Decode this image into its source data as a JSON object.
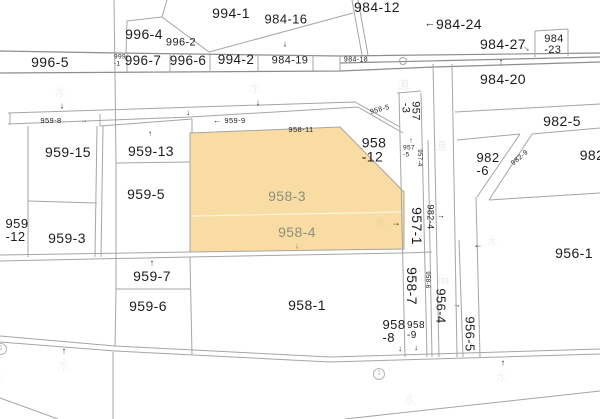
{
  "map": {
    "type": "cadastral-parcel-map",
    "colors": {
      "background": "#ffffff",
      "line": "#a5a5a3",
      "line_dark": "#8d8d8b",
      "highlight_fill": "#f8dca3",
      "highlight_label": "#8c8f7e",
      "label": "#1d1d1d",
      "marker": "#b5b5b5"
    },
    "highlighted_parcels": [
      "958-3",
      "958-4"
    ],
    "labels": [
      {
        "text": "994-1",
        "x": 231,
        "y": 13,
        "size": 14
      },
      {
        "text": "996-4",
        "x": 144,
        "y": 34,
        "size": 14
      },
      {
        "text": "996-2",
        "x": 181,
        "y": 43,
        "size": 11
      },
      {
        "text": "984-16",
        "x": 286,
        "y": 19,
        "size": 13
      },
      {
        "text": "984-12",
        "x": 377,
        "y": 7,
        "size": 14
      },
      {
        "text": "984-24",
        "x": 459,
        "y": 24,
        "size": 14
      },
      {
        "text": "984-27",
        "x": 503,
        "y": 44,
        "size": 14
      },
      {
        "lines": [
          "984",
          "-23"
        ],
        "x": 554,
        "y": 45,
        "size": 11
      },
      {
        "text": "996-5",
        "x": 50,
        "y": 62,
        "size": 14
      },
      {
        "lines": [
          "999",
          "-1"
        ],
        "x": 120,
        "y": 61,
        "size": 6.5
      },
      {
        "text": "996-7",
        "x": 143,
        "y": 61,
        "size": 13.5
      },
      {
        "text": "996-6",
        "x": 188,
        "y": 61,
        "size": 13.5
      },
      {
        "text": "994-2",
        "x": 236,
        "y": 60,
        "size": 13.5
      },
      {
        "text": "984-19",
        "x": 290,
        "y": 61,
        "size": 11
      },
      {
        "text": "984-18",
        "x": 356,
        "y": 60,
        "size": 7
      },
      {
        "text": "道",
        "x": 404,
        "y": 85,
        "size": 16,
        "kanji": "road"
      },
      {
        "text": "984-20",
        "x": 503,
        "y": 79,
        "size": 14
      },
      {
        "text": "水",
        "x": 61,
        "y": 93,
        "size": 16,
        "kanji": "water"
      },
      {
        "text": "水",
        "x": 255,
        "y": 89,
        "size": 16,
        "kanji": "water"
      },
      {
        "text": "959-8",
        "x": 51,
        "y": 121,
        "size": 7.5
      },
      {
        "text": "959-9",
        "x": 235,
        "y": 121,
        "size": 7.5
      },
      {
        "text": "958-11",
        "x": 301,
        "y": 130,
        "size": 7.5
      },
      {
        "text": "958-5",
        "x": 380,
        "y": 110,
        "size": 7,
        "rot": -15
      },
      {
        "text": "957",
        "x": 415,
        "y": 111,
        "size": 11,
        "rot": 90
      },
      {
        "text": "-3",
        "x": 405,
        "y": 108,
        "size": 11,
        "rot": 90
      },
      {
        "text": "959-15",
        "x": 68,
        "y": 152,
        "size": 14
      },
      {
        "text": "959-13",
        "x": 151,
        "y": 151,
        "size": 14
      },
      {
        "lines": [
          "958",
          "-12"
        ],
        "x": 374,
        "y": 150,
        "size": 14
      },
      {
        "text": "982-5",
        "x": 562,
        "y": 121,
        "size": 14
      },
      {
        "text": "982",
        "x": 592,
        "y": 155,
        "size": 14
      },
      {
        "lines": [
          "982",
          "-6"
        ],
        "x": 488,
        "y": 164,
        "size": 13
      },
      {
        "text": "982-9",
        "x": 520,
        "y": 158,
        "size": 7,
        "rot": -40
      },
      {
        "lines": [
          "957",
          "-5"
        ],
        "x": 409,
        "y": 152,
        "size": 6.5
      },
      {
        "text": "957-4",
        "x": 419,
        "y": 158,
        "size": 6,
        "rot": 90
      },
      {
        "text": "道",
        "x": 441,
        "y": 146,
        "size": 16,
        "kanji": "road"
      },
      {
        "text": "959-5",
        "x": 146,
        "y": 194,
        "size": 14
      },
      {
        "lines": [
          "959",
          "-12"
        ],
        "x": 17,
        "y": 230,
        "size": 13
      },
      {
        "text": "959-3",
        "x": 67,
        "y": 238,
        "size": 14
      },
      {
        "text": "958-3",
        "x": 287,
        "y": 196,
        "size": 14,
        "color": "#8c8f7e"
      },
      {
        "text": "958-4",
        "x": 297,
        "y": 232,
        "size": 14,
        "color": "#8c8f7e"
      },
      {
        "text": "水",
        "x": 381,
        "y": 223,
        "size": 14,
        "kanji": "water"
      },
      {
        "text": "957-1",
        "x": 417,
        "y": 226,
        "size": 14,
        "rot": 90
      },
      {
        "text": "982-4",
        "x": 430,
        "y": 217,
        "size": 9,
        "rot": 90
      },
      {
        "text": "水",
        "x": 493,
        "y": 242,
        "size": 14,
        "kanji": "water"
      },
      {
        "text": "956-1",
        "x": 574,
        "y": 253,
        "size": 14
      },
      {
        "text": "959-7",
        "x": 152,
        "y": 276,
        "size": 14
      },
      {
        "text": "959-6",
        "x": 148,
        "y": 306,
        "size": 14
      },
      {
        "text": "958-1",
        "x": 307,
        "y": 305,
        "size": 14
      },
      {
        "text": "958-7",
        "x": 412,
        "y": 286,
        "size": 14,
        "rot": 90
      },
      {
        "text": "958-6",
        "x": 427,
        "y": 280,
        "size": 6,
        "rot": 90
      },
      {
        "text": "道",
        "x": 443,
        "y": 280,
        "size": 15,
        "rot": 90,
        "kanji": "road"
      },
      {
        "text": "956-4",
        "x": 441,
        "y": 306,
        "size": 13,
        "rot": 90
      },
      {
        "text": "956-5",
        "x": 470,
        "y": 334,
        "size": 13,
        "rot": 90
      },
      {
        "lines": [
          "958",
          "-8"
        ],
        "x": 394,
        "y": 331,
        "size": 13
      },
      {
        "lines": [
          "958",
          "-9"
        ],
        "x": 416,
        "y": 331,
        "size": 10
      },
      {
        "text": "水",
        "x": 64,
        "y": 366,
        "size": 16,
        "kanji": "water"
      },
      {
        "text": "水",
        "x": -2,
        "y": 379,
        "size": 14,
        "kanji": "water"
      },
      {
        "text": "水",
        "x": 410,
        "y": 400,
        "size": 16,
        "kanji": "water"
      },
      {
        "text": "水",
        "x": 502,
        "y": 378,
        "size": 15,
        "kanji": "water"
      }
    ],
    "arrows": [
      {
        "glyph": "↓",
        "x": 285,
        "y": 44,
        "size": 9
      },
      {
        "glyph": "←",
        "x": 430,
        "y": 24,
        "size": 11
      },
      {
        "glyph": "→",
        "x": 527,
        "y": 48,
        "size": 9,
        "rot": 40
      },
      {
        "glyph": "↑",
        "x": 501,
        "y": 62,
        "size": 9
      },
      {
        "glyph": "↓",
        "x": 62,
        "y": 106,
        "size": 9
      },
      {
        "glyph": "↓",
        "x": 258,
        "y": 103,
        "size": 9
      },
      {
        "glyph": "↓",
        "x": 188,
        "y": 113,
        "size": 8
      },
      {
        "glyph": "←",
        "x": 217,
        "y": 121,
        "size": 8
      },
      {
        "glyph": "→",
        "x": 84,
        "y": 121,
        "size": 7
      },
      {
        "glyph": "↑",
        "x": 150,
        "y": 134,
        "size": 8
      },
      {
        "glyph": "↑",
        "x": 411,
        "y": 141,
        "size": 7
      },
      {
        "glyph": "→",
        "x": 396,
        "y": 223,
        "size": 9
      },
      {
        "glyph": "→",
        "x": 441,
        "y": 216,
        "size": 8
      },
      {
        "glyph": "←",
        "x": 478,
        "y": 245,
        "size": 9
      },
      {
        "glyph": "↓",
        "x": 297,
        "y": 246,
        "size": 9,
        "color": "#8c8f7e"
      },
      {
        "glyph": "↑",
        "x": 152,
        "y": 263,
        "size": 9
      },
      {
        "glyph": "→",
        "x": 457,
        "y": 305,
        "size": 8,
        "rot": 15
      },
      {
        "glyph": "↓",
        "x": 400,
        "y": 349,
        "size": 8
      },
      {
        "glyph": "↓",
        "x": 416,
        "y": 348,
        "size": 8
      },
      {
        "glyph": "↑",
        "x": 64,
        "y": 351,
        "size": 9
      },
      {
        "glyph": "↑",
        "x": 503,
        "y": 363,
        "size": 9
      }
    ],
    "markers": [
      {
        "symbol": "①",
        "x": 1,
        "y": 349
      },
      {
        "symbol": "①",
        "x": 379,
        "y": 374
      }
    ]
  }
}
